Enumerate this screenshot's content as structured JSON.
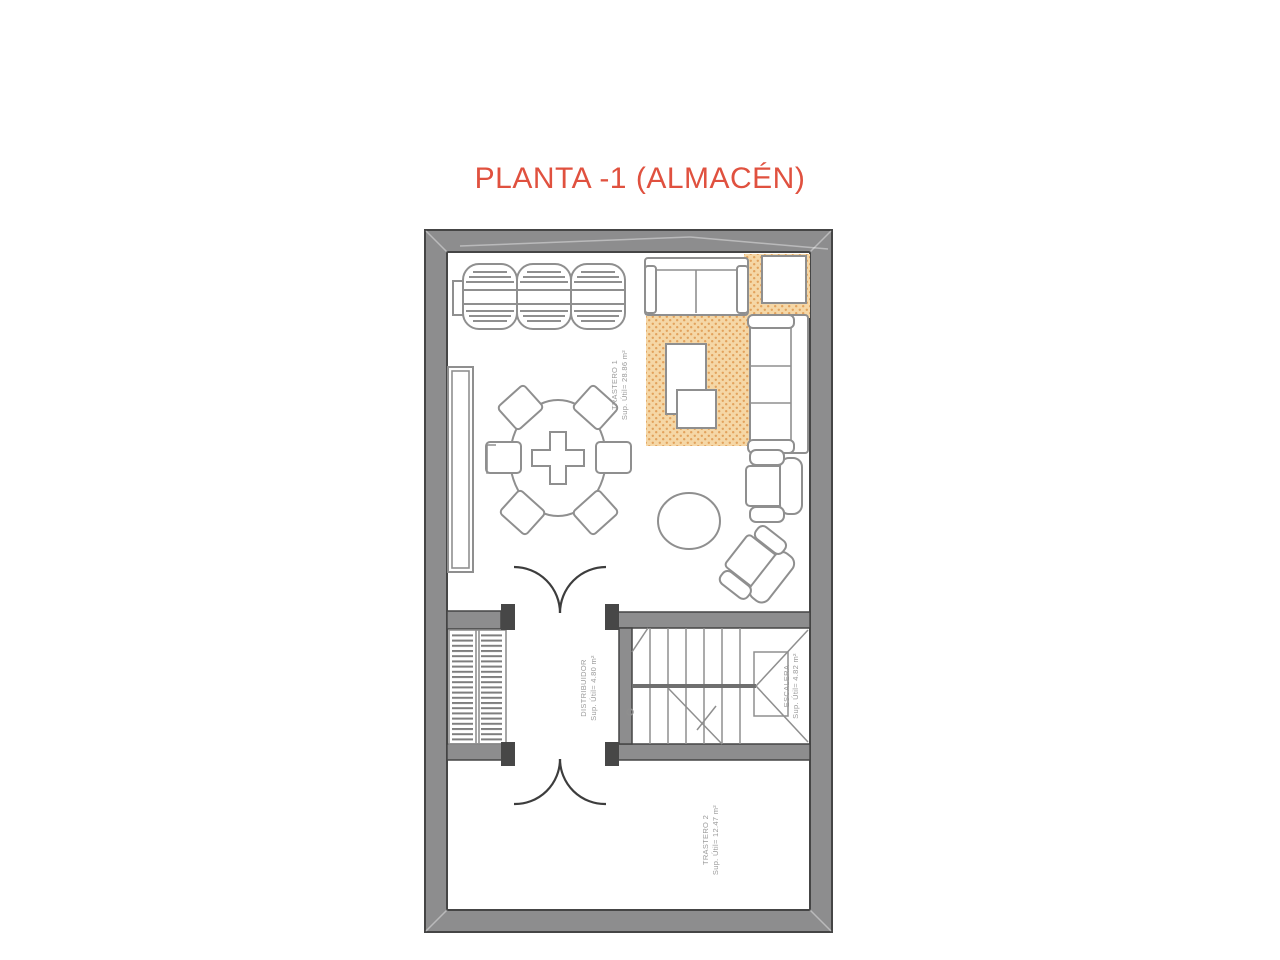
{
  "title": {
    "text": "PLANTA -1 (ALMACÉN)"
  },
  "plan": {
    "rooms": [
      {
        "name": "TRASTERO 1",
        "area": "Sup. Útil= 28.86 m²"
      },
      {
        "name": "DISTRIBUIDOR",
        "area": "Sup. Útil= 4.80 m²"
      },
      {
        "name": "ESCALERA",
        "area": "Sup. Útil= 4.82 m²"
      },
      {
        "name": "TRASTERO 2",
        "area": "Sup. Útil= 12.47 m²"
      }
    ],
    "colors": {
      "title": "#e0513f",
      "wall": "#8d8d8e",
      "wall_edge": "#454545",
      "furniture_line": "#8f8f8f",
      "rug_base": "#f5d7a6",
      "rug_dot": "#e2a25c",
      "label": "#9a9a9a"
    },
    "furniture": [
      "barrel-rack",
      "sofa-top",
      "side-table",
      "rug",
      "sofa-right",
      "coffee-tables",
      "armchair-upper",
      "armchair-lower",
      "ottoman",
      "round-dining-table",
      "dining-chairs",
      "sideboard",
      "shelving-unit",
      "staircase",
      "double-door-upper",
      "double-door-lower"
    ]
  }
}
